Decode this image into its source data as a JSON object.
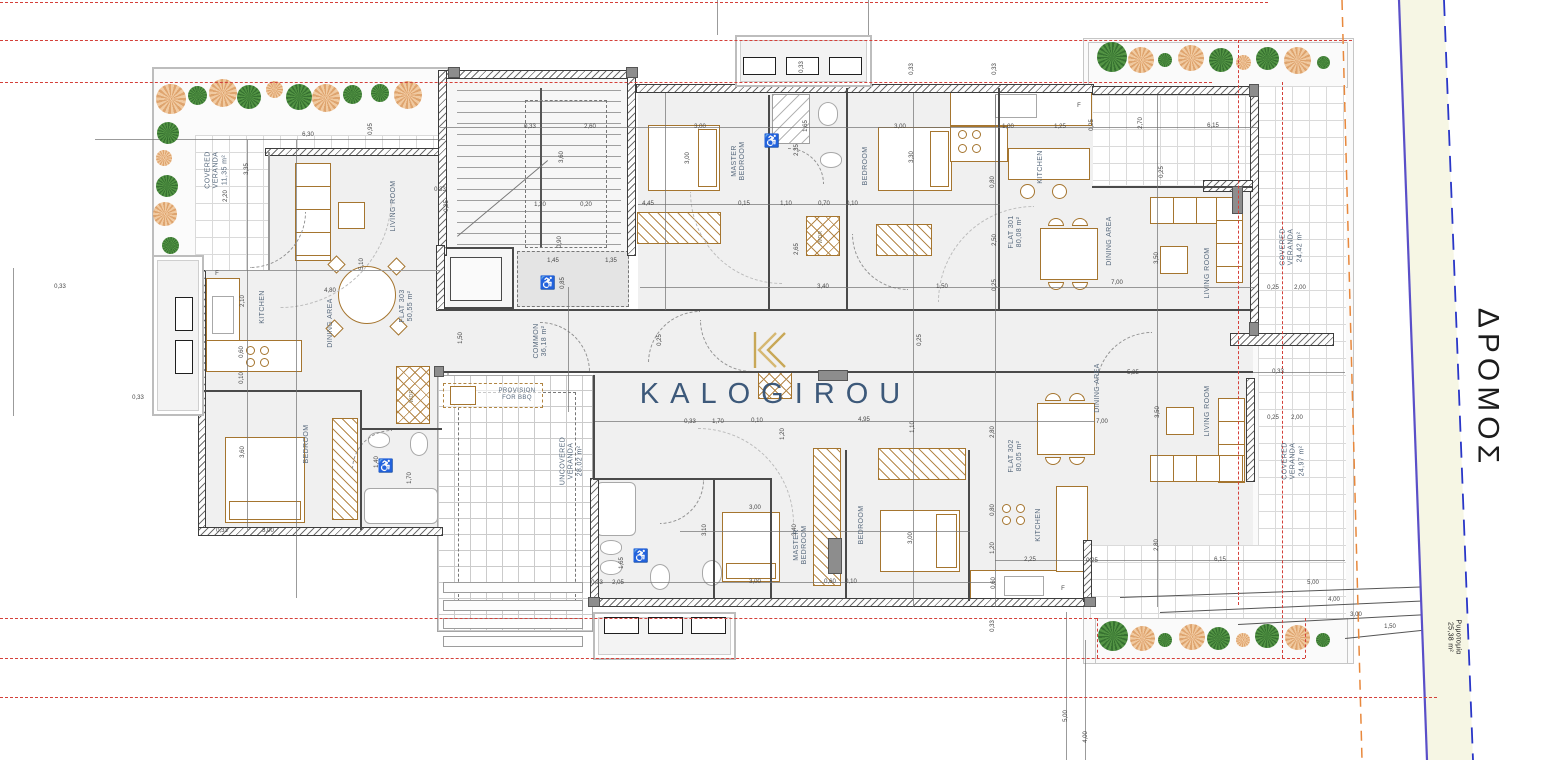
{
  "watermark": {
    "brand": "KALOGIROU"
  },
  "road": {
    "name": "ΔΡΟΜΟΣ",
    "widening_label": "Ρυμοτομία",
    "widening_area": "25,38 m²"
  },
  "common": {
    "label": "COMMON",
    "area": "36,18 m²"
  },
  "uncovered_veranda": {
    "label": "UNCOVERED VERANDA",
    "area": "28,02 m²"
  },
  "provision": {
    "line1": "PROVISION",
    "line2": "FOR BBQ"
  },
  "flats": [
    {
      "id": "FLAT 301",
      "area": "80,08 m²",
      "rooms": [
        "MASTER BEDROOM",
        "BEDROOM",
        "KITCHEN",
        "DINING AREA",
        "LIVING ROOM",
        "COVERED VERANDA 24,42 m²"
      ]
    },
    {
      "id": "FLAT 302",
      "area": "80,05 m²",
      "rooms": [
        "MASTER BEDROOM",
        "BEDROOM",
        "KITCHEN",
        "DINING AREA",
        "LIVING ROOM",
        "COVERED VERANDA 24,97 m²"
      ]
    },
    {
      "id": "FLAT 303",
      "area": "50,55 m²",
      "rooms": [
        "LIVING ROOM",
        "KITCHEN",
        "DINING AREA",
        "BEDROOM",
        "COVERED VERANDA 11,35 m²"
      ]
    }
  ],
  "colors": {
    "boundary_red": "#d4403a",
    "boundary_orange": "#e8883c",
    "road_line": "#5a4fc8",
    "road_dashed": "#2936c8",
    "furniture": "#a5752f",
    "watermark": "#2e4d70",
    "logo_gold": "#c5a24b"
  },
  "room_labels": [
    {
      "lines": [
        "COVERED",
        "VERANDA",
        "11,35 m²"
      ],
      "x": 217,
      "y": 170,
      "r": -90,
      "s": 7
    },
    {
      "lines": [
        "LIVING ROOM"
      ],
      "x": 394,
      "y": 206,
      "r": -90,
      "s": 7
    },
    {
      "lines": [
        "KITCHEN"
      ],
      "x": 263,
      "y": 307,
      "r": -90,
      "s": 7
    },
    {
      "lines": [
        "DINING AREA"
      ],
      "x": 331,
      "y": 323,
      "r": -90,
      "s": 7
    },
    {
      "lines": [
        "FLAT 303",
        "50,55 m²"
      ],
      "x": 407,
      "y": 306,
      "r": -90,
      "s": 7
    },
    {
      "lines": [
        "BEDROOM"
      ],
      "x": 307,
      "y": 444,
      "r": -90,
      "s": 7
    },
    {
      "lines": [
        "WDR"
      ],
      "x": 413,
      "y": 396,
      "r": -90,
      "s": 5,
      "cls": "small"
    },
    {
      "lines": [
        "COMMON",
        "36,18 m²"
      ],
      "x": 541,
      "y": 341,
      "r": -90,
      "s": 7
    },
    {
      "lines": [
        "UNCOVERED",
        "VERANDA",
        "28,02 m²"
      ],
      "x": 572,
      "y": 461,
      "r": -90,
      "s": 7
    },
    {
      "lines": [
        "PROVISION",
        "FOR BBQ"
      ],
      "x": 517,
      "y": 395,
      "r": 0,
      "s": 6
    },
    {
      "lines": [
        "MASTER",
        "BEDROOM"
      ],
      "x": 739,
      "y": 161,
      "r": -90,
      "s": 7
    },
    {
      "lines": [
        "BEDROOM"
      ],
      "x": 866,
      "y": 166,
      "r": -90,
      "s": 7
    },
    {
      "lines": [
        "WDR"
      ],
      "x": 822,
      "y": 237,
      "r": -90,
      "s": 5,
      "cls": "small"
    },
    {
      "lines": [
        "KITCHEN"
      ],
      "x": 1041,
      "y": 167,
      "r": -90,
      "s": 7
    },
    {
      "lines": [
        "FLAT 301",
        "80,08 m²"
      ],
      "x": 1016,
      "y": 232,
      "r": -90,
      "s": 7
    },
    {
      "lines": [
        "DINING AREA"
      ],
      "x": 1110,
      "y": 241,
      "r": -90,
      "s": 7
    },
    {
      "lines": [
        "LIVING ROOM"
      ],
      "x": 1208,
      "y": 273,
      "r": -90,
      "s": 7
    },
    {
      "lines": [
        "COVERED",
        "VERANDA",
        "24,42 m²"
      ],
      "x": 1292,
      "y": 247,
      "r": -90,
      "s": 7
    },
    {
      "lines": [
        "DINING AREA"
      ],
      "x": 1098,
      "y": 388,
      "r": -90,
      "s": 7
    },
    {
      "lines": [
        "LIVING ROOM"
      ],
      "x": 1208,
      "y": 411,
      "r": -90,
      "s": 7
    },
    {
      "lines": [
        "FLAT 302",
        "80,05 m²"
      ],
      "x": 1016,
      "y": 456,
      "r": -90,
      "s": 7
    },
    {
      "lines": [
        "KITCHEN"
      ],
      "x": 1039,
      "y": 525,
      "r": -90,
      "s": 7
    },
    {
      "lines": [
        "MASTER",
        "BEDROOM"
      ],
      "x": 801,
      "y": 545,
      "r": -90,
      "s": 7
    },
    {
      "lines": [
        "BEDROOM"
      ],
      "x": 862,
      "y": 525,
      "r": -90,
      "s": 7
    },
    {
      "lines": [
        "COVERED",
        "VERANDA",
        "24,97 m²"
      ],
      "x": 1294,
      "y": 461,
      "r": -90,
      "s": 7
    },
    {
      "lines": [
        "ΔΡΟΜΟΣ"
      ],
      "x": 1488,
      "y": 388,
      "r": 90,
      "s": 30,
      "cls": "dark",
      "name": "road-label"
    },
    {
      "lines": [
        "Ρυμοτομία",
        "25,38 m²"
      ],
      "x": 1453,
      "y": 637,
      "r": 90,
      "s": 7,
      "cls": "dark-sm",
      "name": "road-widening-label"
    }
  ],
  "dims": [
    {
      "t": "6,30",
      "x": 308,
      "y": 135,
      "r": 0
    },
    {
      "t": "0,95",
      "x": 371,
      "y": 129,
      "r": -90
    },
    {
      "t": "3,35",
      "x": 247,
      "y": 169,
      "r": -90
    },
    {
      "t": "2,20",
      "x": 226,
      "y": 196,
      "r": -90
    },
    {
      "t": "0,33",
      "x": 60,
      "y": 287,
      "r": 0
    },
    {
      "t": "0,33",
      "x": 138,
      "y": 398,
      "r": 0
    },
    {
      "t": "2,10",
      "x": 243,
      "y": 301,
      "r": -90
    },
    {
      "t": "0,60",
      "x": 242,
      "y": 352,
      "r": -90
    },
    {
      "t": "0,10",
      "x": 242,
      "y": 378,
      "r": -90
    },
    {
      "t": "5,10",
      "x": 362,
      "y": 264,
      "r": -90
    },
    {
      "t": "4,80",
      "x": 330,
      "y": 291,
      "r": 0
    },
    {
      "t": "3,60",
      "x": 243,
      "y": 452,
      "r": -90
    },
    {
      "t": "3,00",
      "x": 268,
      "y": 531,
      "r": 0
    },
    {
      "t": "0,33",
      "x": 222,
      "y": 531,
      "r": 0
    },
    {
      "t": "1,70",
      "x": 410,
      "y": 478,
      "r": -90
    },
    {
      "t": "1,40",
      "x": 377,
      "y": 462,
      "r": -90
    },
    {
      "t": "0,33",
      "x": 440,
      "y": 190,
      "r": 0
    },
    {
      "t": "0,25",
      "x": 447,
      "y": 206,
      "r": -90
    },
    {
      "t": "1,50",
      "x": 461,
      "y": 338,
      "r": -90
    },
    {
      "t": "0,33",
      "x": 530,
      "y": 127,
      "r": 0
    },
    {
      "t": "2,60",
      "x": 590,
      "y": 127,
      "r": 0
    },
    {
      "t": "3,60",
      "x": 562,
      "y": 157,
      "r": -90
    },
    {
      "t": "1,20",
      "x": 540,
      "y": 205,
      "r": 0
    },
    {
      "t": "0,20",
      "x": 586,
      "y": 205,
      "r": 0
    },
    {
      "t": "0,90",
      "x": 560,
      "y": 242,
      "r": -90
    },
    {
      "t": "1,45",
      "x": 553,
      "y": 261,
      "r": 0
    },
    {
      "t": "1,35",
      "x": 611,
      "y": 261,
      "r": 0
    },
    {
      "t": "0,85",
      "x": 563,
      "y": 283,
      "r": -90
    },
    {
      "t": "0,33",
      "x": 802,
      "y": 67,
      "r": -90
    },
    {
      "t": "0,33",
      "x": 912,
      "y": 69,
      "r": -90
    },
    {
      "t": "0,33",
      "x": 995,
      "y": 69,
      "r": -90
    },
    {
      "t": "3,00",
      "x": 700,
      "y": 127,
      "r": 0
    },
    {
      "t": "3,00",
      "x": 688,
      "y": 158,
      "r": -90
    },
    {
      "t": "4,45",
      "x": 648,
      "y": 204,
      "r": 0
    },
    {
      "t": "0,15",
      "x": 744,
      "y": 204,
      "r": 0
    },
    {
      "t": "1,10",
      "x": 786,
      "y": 204,
      "r": 0
    },
    {
      "t": "0,70",
      "x": 824,
      "y": 204,
      "r": 0
    },
    {
      "t": "0,10",
      "x": 852,
      "y": 204,
      "r": 0
    },
    {
      "t": "1,65",
      "x": 806,
      "y": 126,
      "r": -90
    },
    {
      "t": "2,35",
      "x": 797,
      "y": 150,
      "r": -90
    },
    {
      "t": "3,30",
      "x": 912,
      "y": 157,
      "r": -90
    },
    {
      "t": "3,00",
      "x": 900,
      "y": 127,
      "r": 0
    },
    {
      "t": "2,65",
      "x": 797,
      "y": 249,
      "r": -90
    },
    {
      "t": "3,40",
      "x": 823,
      "y": 287,
      "r": 0
    },
    {
      "t": "1,50",
      "x": 942,
      "y": 287,
      "r": 0
    },
    {
      "t": "1,00",
      "x": 1008,
      "y": 127,
      "r": 0
    },
    {
      "t": "1,25",
      "x": 1060,
      "y": 127,
      "r": 0
    },
    {
      "t": "0,25",
      "x": 1092,
      "y": 125,
      "r": -90
    },
    {
      "t": "2,70",
      "x": 1141,
      "y": 123,
      "r": -90
    },
    {
      "t": "6,15",
      "x": 1213,
      "y": 126,
      "r": 0
    },
    {
      "t": "0,80",
      "x": 993,
      "y": 182,
      "r": -90
    },
    {
      "t": "0,25",
      "x": 1162,
      "y": 172,
      "r": -90
    },
    {
      "t": "2,50",
      "x": 995,
      "y": 240,
      "r": -90
    },
    {
      "t": "3,50",
      "x": 1157,
      "y": 258,
      "r": -90
    },
    {
      "t": "7,00",
      "x": 1117,
      "y": 283,
      "r": 0
    },
    {
      "t": "0,25",
      "x": 995,
      "y": 285,
      "r": -90
    },
    {
      "t": "2,00",
      "x": 1300,
      "y": 288,
      "r": 0
    },
    {
      "t": "0,25",
      "x": 1273,
      "y": 288,
      "r": 0
    },
    {
      "t": "0,33",
      "x": 1278,
      "y": 372,
      "r": 0
    },
    {
      "t": "2,00",
      "x": 1297,
      "y": 418,
      "r": 0
    },
    {
      "t": "0,25",
      "x": 1273,
      "y": 418,
      "r": 0
    },
    {
      "t": "5,25",
      "x": 1133,
      "y": 373,
      "r": 0
    },
    {
      "t": "3,50",
      "x": 1158,
      "y": 412,
      "r": -90
    },
    {
      "t": "2,80",
      "x": 993,
      "y": 432,
      "r": -90
    },
    {
      "t": "7,00",
      "x": 1102,
      "y": 422,
      "r": 0
    },
    {
      "t": "0,80",
      "x": 993,
      "y": 510,
      "r": -90
    },
    {
      "t": "1,20",
      "x": 993,
      "y": 548,
      "r": -90
    },
    {
      "t": "2,80",
      "x": 1157,
      "y": 545,
      "r": -90
    },
    {
      "t": "6,15",
      "x": 1220,
      "y": 560,
      "r": 0
    },
    {
      "t": "0,25",
      "x": 1092,
      "y": 561,
      "r": 0
    },
    {
      "t": "2,25",
      "x": 1030,
      "y": 560,
      "r": 0
    },
    {
      "t": "0,60",
      "x": 994,
      "y": 583,
      "r": -90
    },
    {
      "t": "0,33",
      "x": 690,
      "y": 422,
      "r": 0
    },
    {
      "t": "1,70",
      "x": 718,
      "y": 422,
      "r": 0
    },
    {
      "t": "0,10",
      "x": 757,
      "y": 421,
      "r": 0
    },
    {
      "t": "1,20",
      "x": 783,
      "y": 434,
      "r": -90
    },
    {
      "t": "4,95",
      "x": 864,
      "y": 420,
      "r": 0
    },
    {
      "t": "1,10",
      "x": 913,
      "y": 427,
      "r": -90
    },
    {
      "t": "3,10",
      "x": 705,
      "y": 530,
      "r": -90
    },
    {
      "t": "3,00",
      "x": 755,
      "y": 508,
      "r": 0
    },
    {
      "t": "3,40",
      "x": 795,
      "y": 530,
      "r": -90
    },
    {
      "t": "3,00",
      "x": 911,
      "y": 538,
      "r": -90
    },
    {
      "t": "3,00",
      "x": 755,
      "y": 582,
      "r": 0
    },
    {
      "t": "0,60",
      "x": 830,
      "y": 582,
      "r": 0
    },
    {
      "t": "0,10",
      "x": 851,
      "y": 582,
      "r": 0
    },
    {
      "t": "2,05",
      "x": 618,
      "y": 583,
      "r": 0
    },
    {
      "t": "0,33",
      "x": 597,
      "y": 583,
      "r": 0
    },
    {
      "t": "1,65",
      "x": 622,
      "y": 563,
      "r": -90
    },
    {
      "t": "5,00",
      "x": 1313,
      "y": 583,
      "r": 0
    },
    {
      "t": "4,00",
      "x": 1334,
      "y": 600,
      "r": 0
    },
    {
      "t": "3,00",
      "x": 1356,
      "y": 615,
      "r": 0
    },
    {
      "t": "1,50",
      "x": 1390,
      "y": 627,
      "r": 0
    },
    {
      "t": "5,00",
      "x": 1066,
      "y": 716,
      "r": -90
    },
    {
      "t": "4,00",
      "x": 1086,
      "y": 737,
      "r": -90
    },
    {
      "t": "0,33",
      "x": 993,
      "y": 626,
      "r": -90
    },
    {
      "t": "0,25",
      "x": 660,
      "y": 340,
      "r": -90
    },
    {
      "t": "0,25",
      "x": 920,
      "y": 340,
      "r": -90
    },
    {
      "t": "F",
      "x": 217,
      "y": 274,
      "r": 0
    },
    {
      "t": "F",
      "x": 1079,
      "y": 106,
      "r": 0
    },
    {
      "t": "F",
      "x": 1063,
      "y": 589,
      "r": 0
    }
  ],
  "trees": [
    {
      "x": 171,
      "y": 99,
      "d": 30,
      "c": "o"
    },
    {
      "x": 197,
      "y": 95,
      "d": 19,
      "c": "g"
    },
    {
      "x": 223,
      "y": 93,
      "d": 28,
      "c": "o"
    },
    {
      "x": 249,
      "y": 97,
      "d": 24,
      "c": "g"
    },
    {
      "x": 274,
      "y": 89,
      "d": 17,
      "c": "o"
    },
    {
      "x": 299,
      "y": 97,
      "d": 26,
      "c": "g"
    },
    {
      "x": 326,
      "y": 98,
      "d": 28,
      "c": "o"
    },
    {
      "x": 352,
      "y": 94,
      "d": 19,
      "c": "g"
    },
    {
      "x": 380,
      "y": 93,
      "d": 18,
      "c": "g"
    },
    {
      "x": 408,
      "y": 95,
      "d": 28,
      "c": "o"
    },
    {
      "x": 168,
      "y": 133,
      "d": 22,
      "c": "g"
    },
    {
      "x": 164,
      "y": 158,
      "d": 16,
      "c": "o"
    },
    {
      "x": 167,
      "y": 186,
      "d": 22,
      "c": "g"
    },
    {
      "x": 165,
      "y": 214,
      "d": 24,
      "c": "o"
    },
    {
      "x": 170,
      "y": 245,
      "d": 17,
      "c": "g"
    },
    {
      "x": 1112,
      "y": 57,
      "d": 30,
      "c": "g"
    },
    {
      "x": 1141,
      "y": 60,
      "d": 26,
      "c": "o"
    },
    {
      "x": 1165,
      "y": 60,
      "d": 14,
      "c": "g"
    },
    {
      "x": 1191,
      "y": 58,
      "d": 26,
      "c": "o"
    },
    {
      "x": 1221,
      "y": 60,
      "d": 24,
      "c": "g"
    },
    {
      "x": 1243,
      "y": 62,
      "d": 15,
      "c": "o"
    },
    {
      "x": 1267,
      "y": 58,
      "d": 23,
      "c": "g"
    },
    {
      "x": 1297,
      "y": 60,
      "d": 27,
      "c": "o"
    },
    {
      "x": 1323,
      "y": 62,
      "d": 13,
      "c": "g"
    },
    {
      "x": 1113,
      "y": 636,
      "d": 30,
      "c": "g"
    },
    {
      "x": 1142,
      "y": 638,
      "d": 25,
      "c": "o"
    },
    {
      "x": 1165,
      "y": 640,
      "d": 14,
      "c": "g"
    },
    {
      "x": 1192,
      "y": 637,
      "d": 26,
      "c": "o"
    },
    {
      "x": 1218,
      "y": 638,
      "d": 23,
      "c": "g"
    },
    {
      "x": 1243,
      "y": 640,
      "d": 14,
      "c": "o"
    },
    {
      "x": 1267,
      "y": 636,
      "d": 24,
      "c": "g"
    },
    {
      "x": 1297,
      "y": 637,
      "d": 25,
      "c": "o"
    },
    {
      "x": 1323,
      "y": 640,
      "d": 14,
      "c": "g"
    }
  ],
  "ac_units": [
    {
      "x": 743,
      "y": 57,
      "w": 33,
      "h": 18
    },
    {
      "x": 786,
      "y": 57,
      "w": 33,
      "h": 18
    },
    {
      "x": 829,
      "y": 57,
      "w": 33,
      "h": 18
    },
    {
      "x": 604,
      "y": 617,
      "w": 35,
      "h": 17
    },
    {
      "x": 648,
      "y": 617,
      "w": 35,
      "h": 17
    },
    {
      "x": 691,
      "y": 617,
      "w": 35,
      "h": 17
    },
    {
      "x": 175,
      "y": 297,
      "w": 18,
      "h": 34
    },
    {
      "x": 175,
      "y": 340,
      "w": 18,
      "h": 34
    }
  ],
  "icons": [
    {
      "glyph": "♿",
      "x": 548,
      "y": 283
    },
    {
      "glyph": "♿",
      "x": 772,
      "y": 141
    },
    {
      "glyph": "♿",
      "x": 386,
      "y": 466
    },
    {
      "glyph": "♿",
      "x": 641,
      "y": 556
    }
  ]
}
